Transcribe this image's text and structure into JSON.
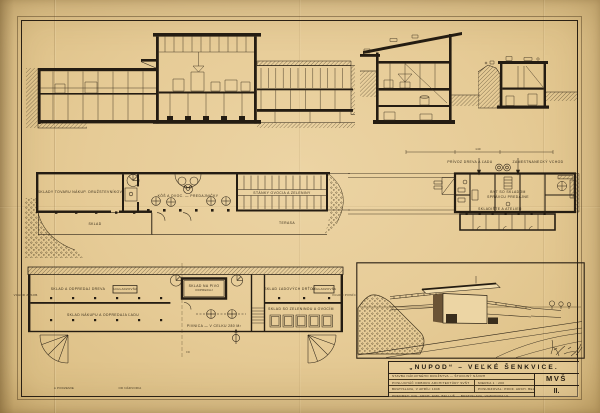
{
  "sheet": {
    "title": "„NUPOD“ – VEĽKÉ ŠENKVICE.",
    "mark": "MVŠ",
    "sheet_no": "II.",
    "rows": {
      "r1": "STAVBA NÁKUPNÉHO DRUŽSTVA — ŠTUDIJNÝ NÁVRH",
      "r2l": "POSLUCHÁČ ODBORU ARCHITEKTÚRY SVŠT",
      "r2r": "MIERKA 1 : 200",
      "r3l": "BRATISLAVA, V APRÍLI 1948",
      "r3r": "POSUDZOVAL: PROF. ARCH. BELLUŠ",
      "r4": "PREDMET: ING. ARCH. EMIL BELLUŠ — BRATISLAVA, VAZOVOVA UL."
    }
  },
  "labels": {
    "mid_plan": {
      "storeroom": "SKLADY TOVARU NÁKUP. DRUŽSTEVNÍKOV",
      "sklad": "SKLAD",
      "hall": "KÔŠ A OVOC. — PREDAJNIČKY",
      "stalls": "STÁNKY OVOCIA A ZELENINY",
      "terasa": "TERASA"
    },
    "right_plan": {
      "dim": "140",
      "delivery": "PRÍVOZ DREVA A ĽADU",
      "staff": "ZAMESTNANECKÝ VCHOD",
      "flat1": "BYT SO SKLADOM",
      "flat2": "SPRÁVCU PREDAJNE",
      "bottom": "SKLADIŠTE A ATELIER"
    },
    "bottom_plan": {
      "left_outer": "VCHOD ZÁSOB.",
      "room_tl": "SKLAD A ODPREDAJ DREVA",
      "box_tl": "SCHLADZOVŇA",
      "room_bl": "SKLAD NÁKUPU A ODPREDAJA ĽADU",
      "beer1": "SKLAD NA PIVO",
      "beer2": "ODPREDAJ",
      "cellar": "PIVNICA — V CELKU 280 M²",
      "room_tr": "SKLAD ĽADOVÝCH DRŤOV",
      "box_tr": "SCHLADZOVŇA",
      "room_br": "SKLAD SO ZELENINOU A OVOCÍM",
      "right_outer": "VCHOD PIVNÍC",
      "level": "±0",
      "cap_a": "A PODZEMIE",
      "cap_b": "OD NÁDVORIA"
    }
  },
  "colors": {
    "paper": "#e6cb96",
    "ink": "#2a2118"
  }
}
